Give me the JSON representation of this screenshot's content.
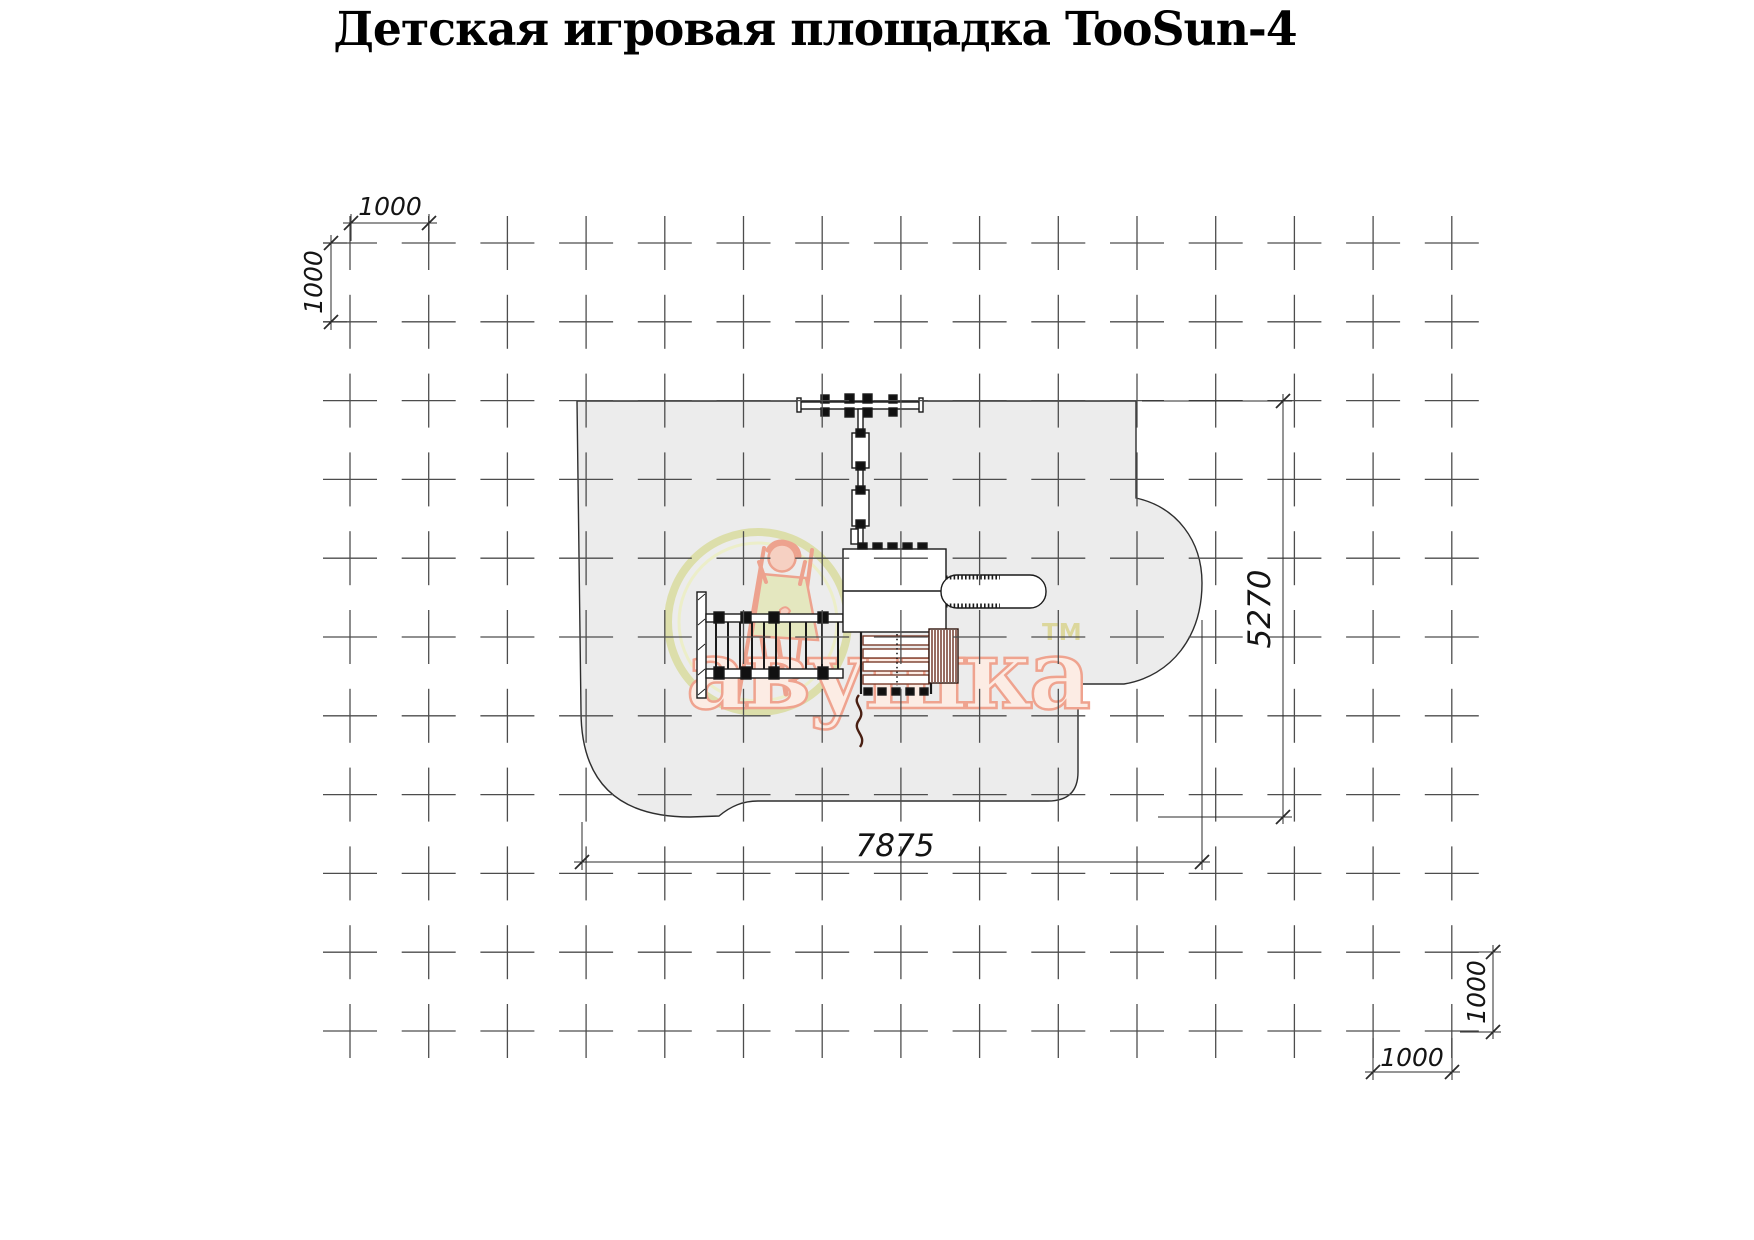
{
  "title": "Детская игровая площадка TooSun-4",
  "dimensions": {
    "top_horizontal_step": "1000",
    "top_vertical_step": "1000",
    "zone_width": "7875",
    "zone_height": "5270",
    "bottom_right_vertical_step": "1000",
    "bottom_right_horizontal_step": "1000"
  },
  "watermark": {
    "brand_text": "авушка",
    "trademark": "ТМ"
  },
  "grid": {
    "columns": 15,
    "rows": 11,
    "step_label_mm": "1000"
  },
  "colors": {
    "safety_zone_fill": "#ececec",
    "drawing_line": "#2e2e2e",
    "grid_cross": "#4d4d4d",
    "watermark_salmon": "#efa38f",
    "watermark_khaki": "#dcdeaa",
    "equipment_brown": "#6b2e1f"
  }
}
